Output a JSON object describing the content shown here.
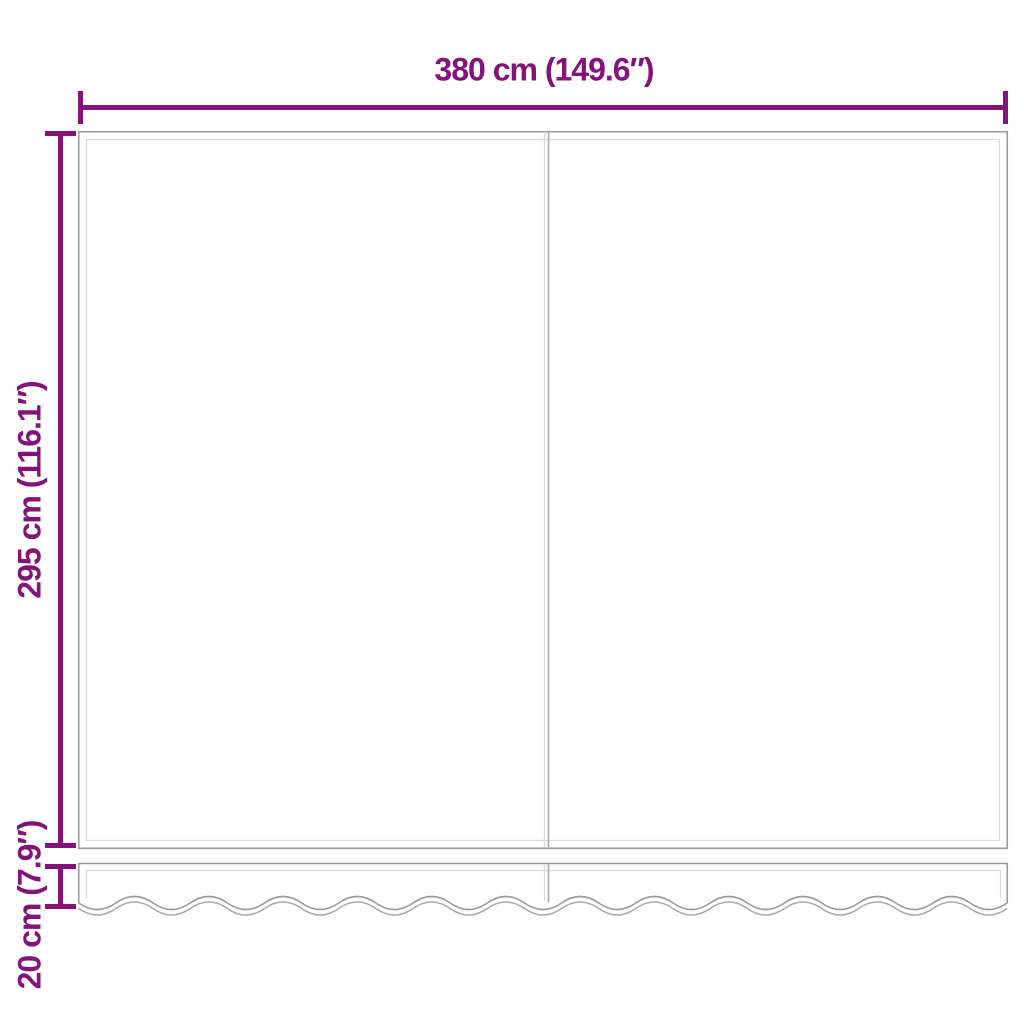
{
  "diagram": {
    "type": "dimension-drawing",
    "subject": "awning replacement fabric with wavy valance, two panels",
    "labels": {
      "width": "380 cm (149.6″)",
      "height": "295 cm (116.1″)",
      "valance": "20 cm (7.9″)"
    },
    "colors": {
      "dimension": "#821379",
      "outline_dark": "#9a9a9a",
      "outline_light": "#d9d9d9",
      "seam_mid": "#a8a8a8",
      "background": "#ffffff"
    },
    "measurements": {
      "fabric_width_cm": 380,
      "fabric_height_cm": 295,
      "valance_height_cm": 20
    }
  }
}
